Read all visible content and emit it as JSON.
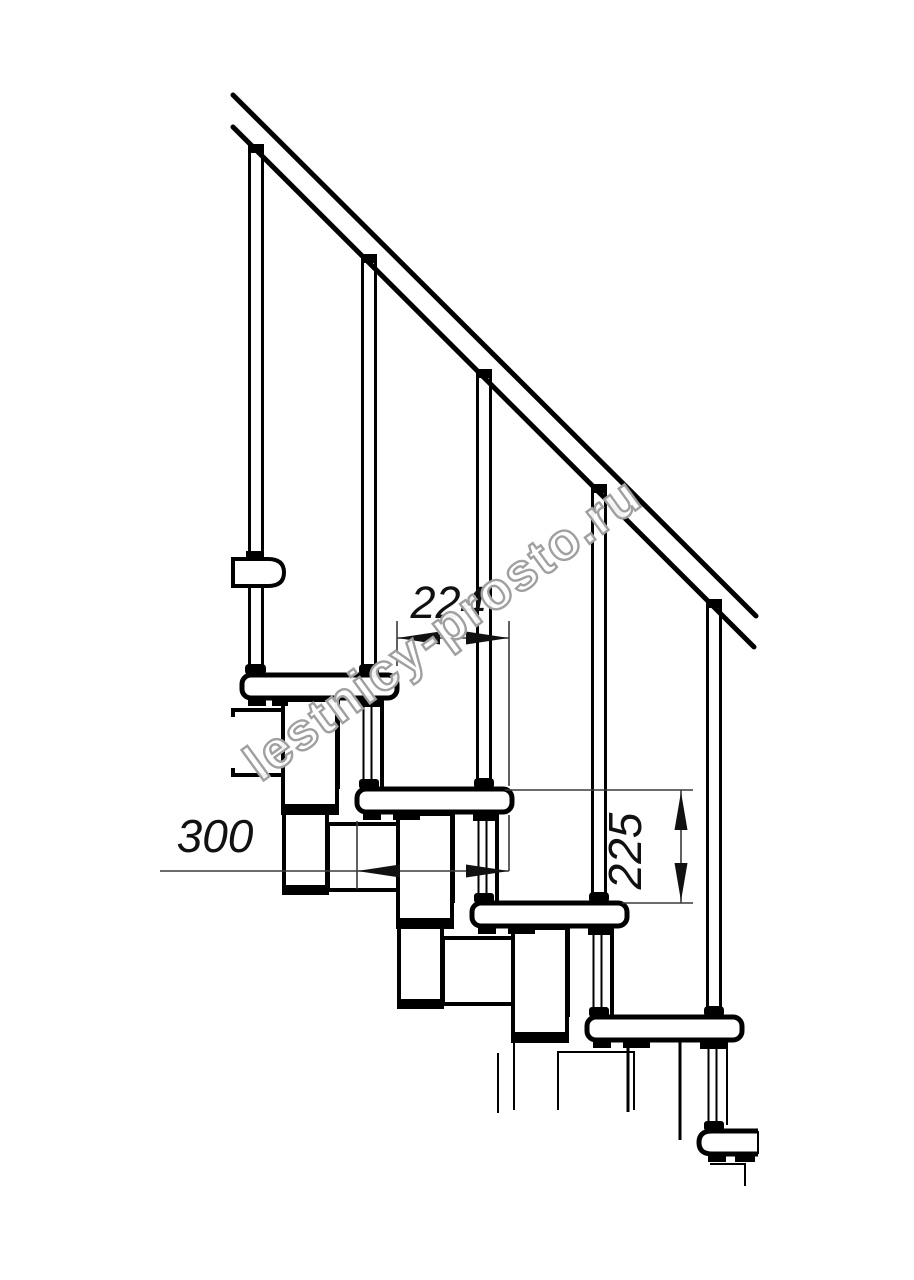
{
  "watermark": {
    "text": "lestnicy-prosto.ru",
    "color": "#a0a0a0"
  },
  "dimensions": {
    "going_mm": "224",
    "tread_depth_mm": "300",
    "rise_mm": "225"
  },
  "colors": {
    "background": "#ffffff",
    "lines": "#000000",
    "dimension_lines": "#3a3a3a"
  }
}
